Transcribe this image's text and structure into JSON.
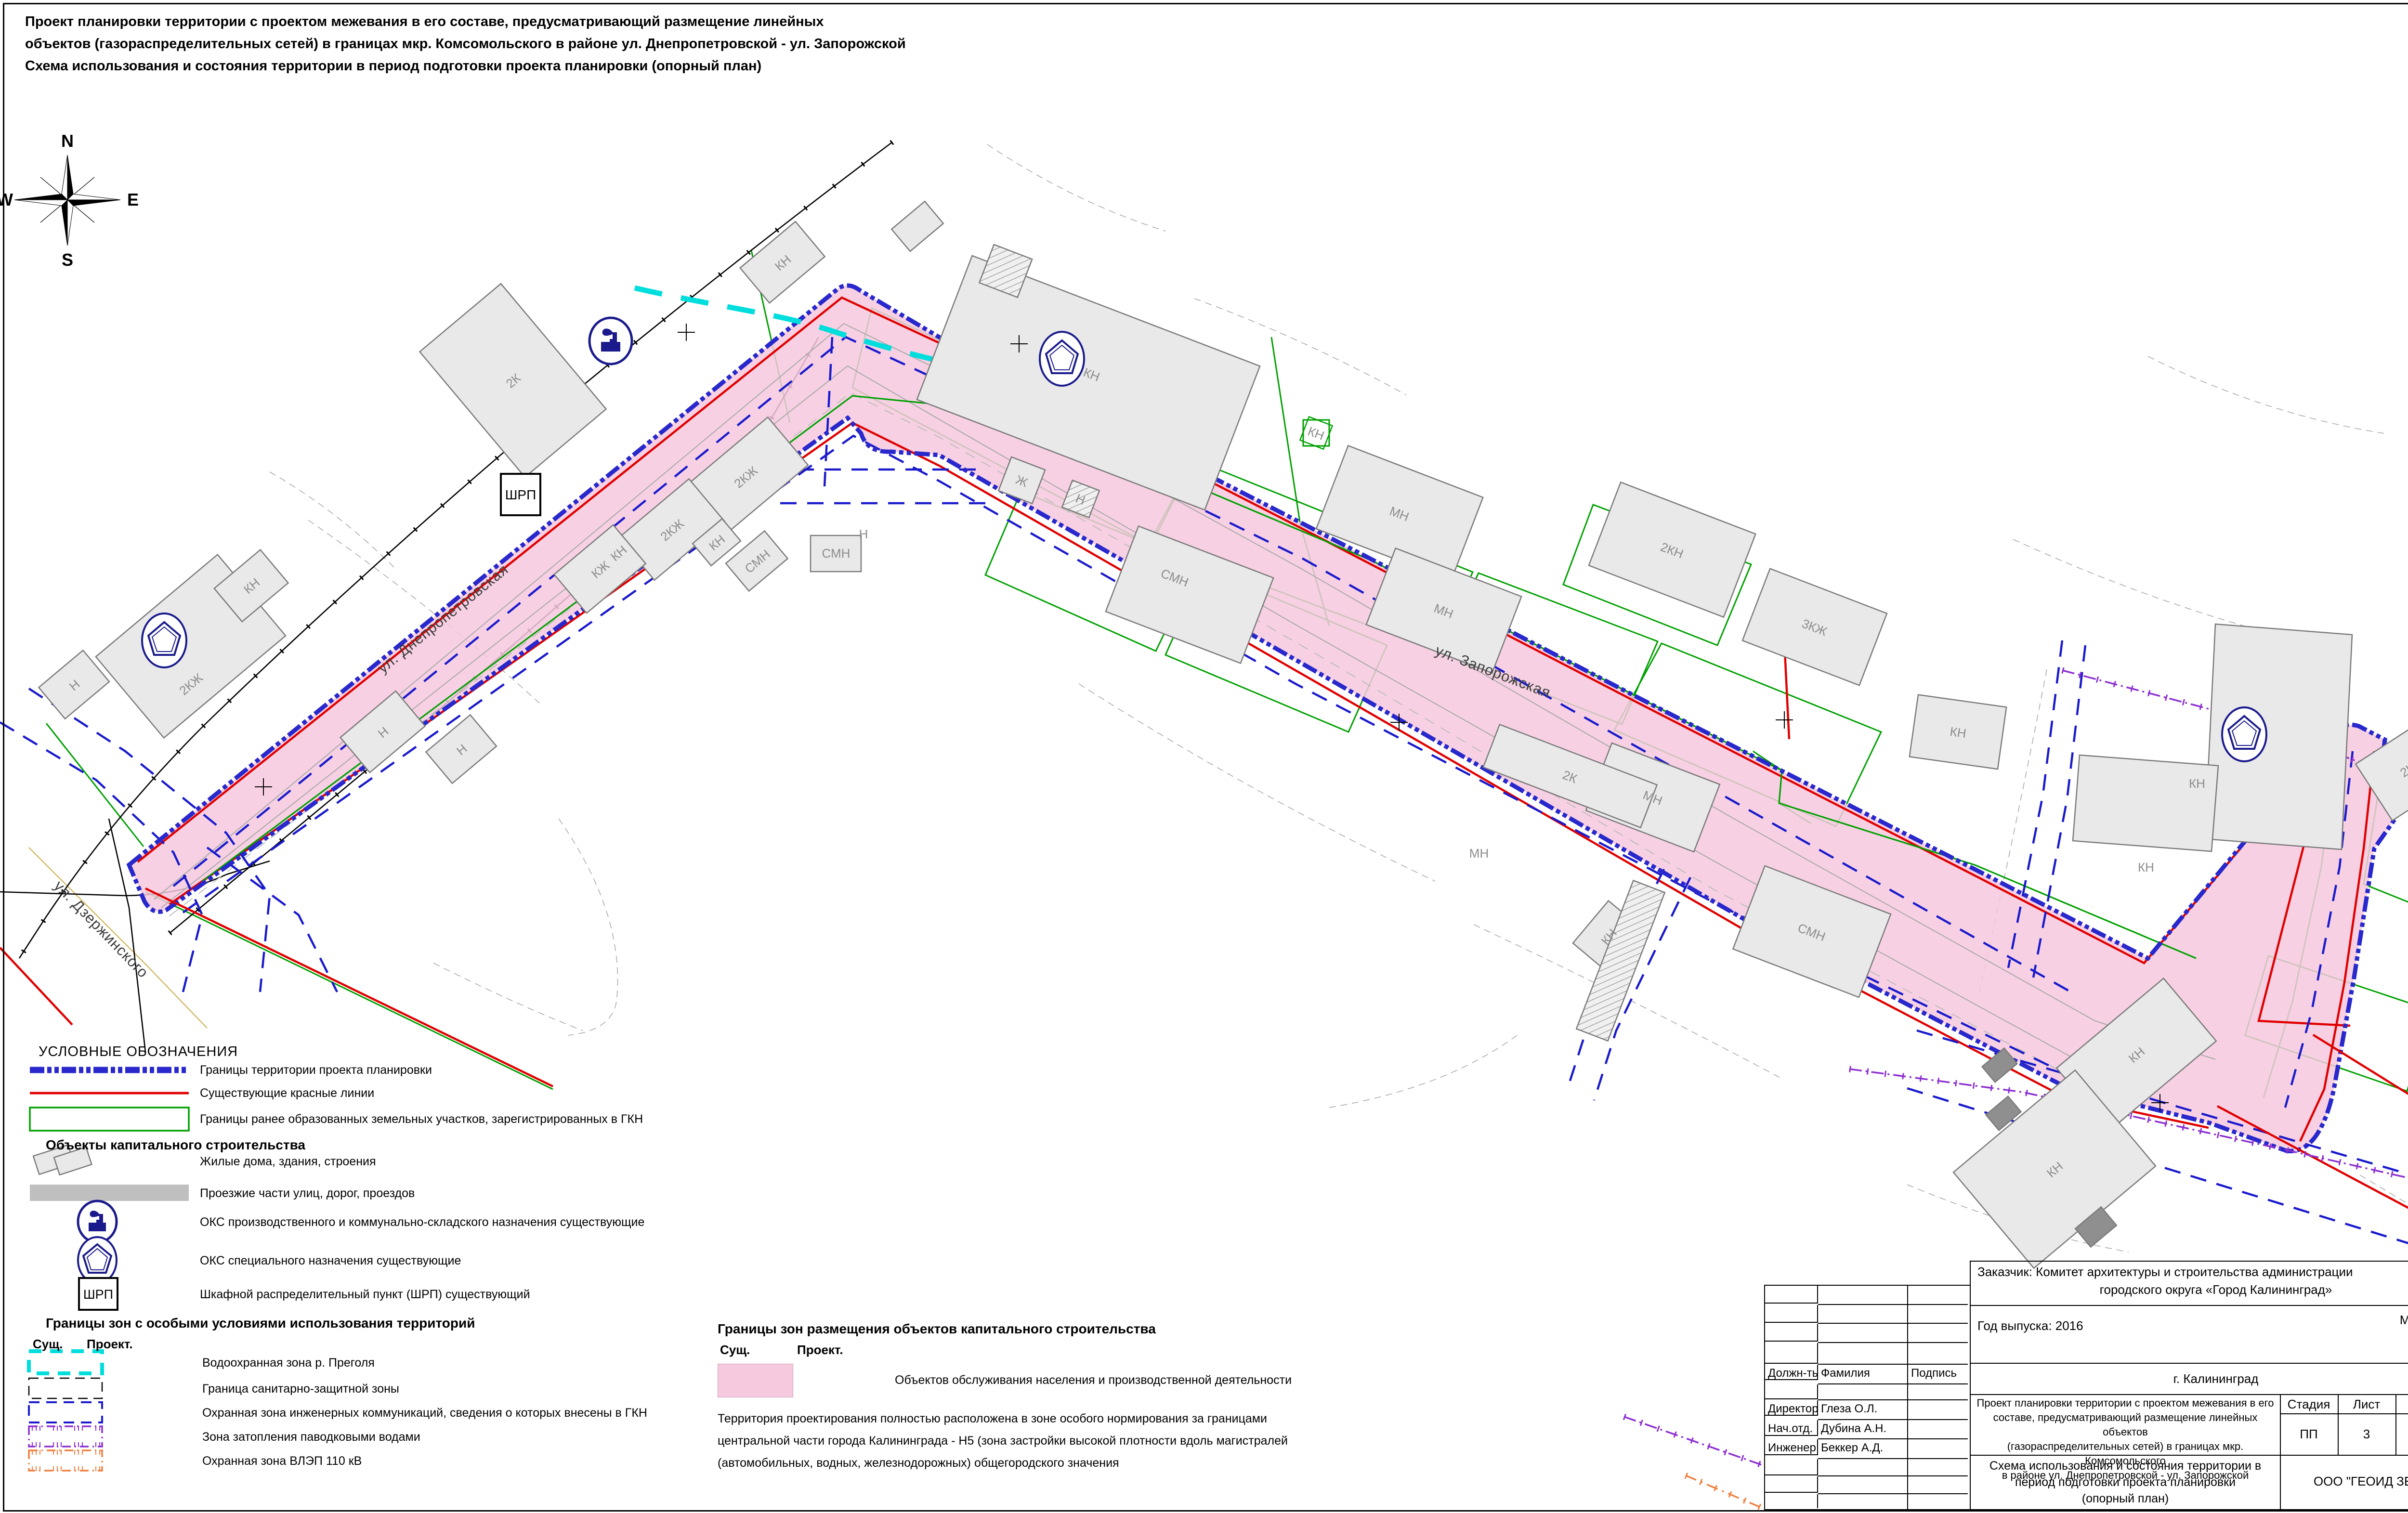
{
  "colors": {
    "corridor_fill": "#F6C9DE",
    "boundary_blue": "#2828CC",
    "red_line": "#E00000",
    "parcel_green": "#00A000",
    "water_cyan": "#00DDDD",
    "flood_purple": "#8C2FD0",
    "power_orange": "#F08040",
    "building_fill": "#E9E9E9",
    "icon_navy": "#1A1A8C"
  },
  "title": {
    "line1": "Проект планировки территории с проектом межевания в его составе, предусматривающий размещение линейных",
    "line2": "объектов (газораспределительных сетей) в границах мкр. Комсомольского в районе ул. Днепропетровской - ул. Запорожской",
    "line3": "Схема использования и состояния территории в период подготовки проекта планировки (опорный план)"
  },
  "compass": {
    "n": "N",
    "e": "E",
    "s": "S",
    "w": "W"
  },
  "map": {
    "shrp_label": "ШРП",
    "streets": [
      {
        "label": "ул. Днепропетровская"
      },
      {
        "label": "ул. Запорожская"
      },
      {
        "label": "ул. Дзержинского"
      }
    ],
    "buildings": [
      {
        "label": "2К"
      },
      {
        "label": "КН"
      },
      {
        "label": "КН"
      },
      {
        "label": "Ж"
      },
      {
        "label": "Н"
      },
      {
        "label": "2КЖ"
      },
      {
        "label": "2КЖ"
      },
      {
        "label": "КЖ"
      },
      {
        "label": "КН"
      },
      {
        "label": "КН"
      },
      {
        "label": "СМН"
      },
      {
        "label": "СМН"
      },
      {
        "label": "Н"
      },
      {
        "label": "МН"
      },
      {
        "label": "МН"
      },
      {
        "label": "2КН"
      },
      {
        "label": "3КЖ"
      },
      {
        "label": "КН"
      },
      {
        "label": "МН"
      },
      {
        "label": "2К"
      },
      {
        "label": "СМН"
      },
      {
        "label": "СМН"
      },
      {
        "label": "КН"
      },
      {
        "label": "Н"
      },
      {
        "label": "Н"
      },
      {
        "label": "2КЖ"
      },
      {
        "label": "КН"
      },
      {
        "label": "Н"
      },
      {
        "label": "КН"
      },
      {
        "label": "КН"
      },
      {
        "label": "КН"
      },
      {
        "label": "КЖ"
      },
      {
        "label": "2КЖ"
      },
      {
        "label": "КН"
      },
      {
        "label": "КН"
      },
      {
        "label": "МН"
      }
    ]
  },
  "legend": {
    "header": "УСЛОВНЫЕ ОБОЗНАЧЕНИЯ",
    "items": [
      {
        "label": "Границы территории проекта планировки"
      },
      {
        "label": "Существующие красные линии"
      },
      {
        "label": "Границы ранее образованных земельных участков, зарегистрированных в ГКН"
      }
    ],
    "oks_header": "Объекты капитального строительства",
    "oks_items": [
      {
        "label": "Жилые дома, здания, строения"
      },
      {
        "label": "Проезжие части улиц, дорог, проездов"
      },
      {
        "label": "ОКС производственного и коммунально-складского назначения существующие"
      },
      {
        "label": "ОКС специального назначения существующие"
      },
      {
        "label": "Шкафной распределительный пункт (ШРП) существующий"
      }
    ],
    "zones_header": "Границы зон с особыми условиями использования территорий",
    "col_existing": "Сущ.",
    "col_project": "Проект.",
    "zone_items": [
      {
        "label": "Водоохранная зона р. Преголя"
      },
      {
        "label": "Граница санитарно-защитной зоны"
      },
      {
        "label": "Охранная зона инженерных коммуникаций, сведения о которых внесены в ГКН"
      },
      {
        "label": "Зона затопления паводковыми водами"
      },
      {
        "label": "Охранная зона ВЛЭП 110 кВ"
      }
    ]
  },
  "legend2": {
    "header": "Границы зон размещения объектов капитального строительства",
    "col_existing": "Сущ.",
    "col_project": "Проект.",
    "item": "Объектов обслуживания населения и производственной деятельности",
    "note_line1": "Территория проектирования полностью расположена в зоне особого нормирования за границами",
    "note_line2": "центральной части города Калининграда - Н5 (зона застройки высокой плотности вдоль магистралей",
    "note_line3": "(автомобильных, водных, железнодорожных) общегородского значения"
  },
  "titleblock": {
    "customer_line1": "Заказчик: Комитет архитектуры и строительства администрации",
    "customer_line2": "городского округа «Город Калининград»",
    "year": "Год выпуска: 2016",
    "scale_label": "Масштаб",
    "scale_value": "1:1000",
    "city": "г. Калининград",
    "col_position": "Должн-ть",
    "col_name": "Фамилия",
    "col_sign": "Подпись",
    "rows": [
      {
        "position": "Директор",
        "name": "Глеза О.Л."
      },
      {
        "position": "Нач.отд.",
        "name": "Дубина А.Н."
      },
      {
        "position": "Инженер",
        "name": "Беккер А.Д."
      }
    ],
    "project_title_l1": "Проект планировки территории с проектом межевания в его",
    "project_title_l2": "составе, предусматривающий размещение линейных объектов",
    "project_title_l3": "(газораспределительных сетей) в границах мкр. Комсомольского",
    "project_title_l4": "в районе ул. Днепропетровской - ул. Запорожской",
    "stage_label": "Стадия",
    "sheet_label": "Лист",
    "sheets_label": "Листов",
    "stage_value": "ПП",
    "sheet_value": "3",
    "sheets_value": "7",
    "scheme_l1": "Схема использования и состояния территории в",
    "scheme_l2": "период подготовки проекта планировки",
    "scheme_l3": "(опорный план)",
    "company": "ООО \"ГЕОИД ЗЕМ\""
  }
}
